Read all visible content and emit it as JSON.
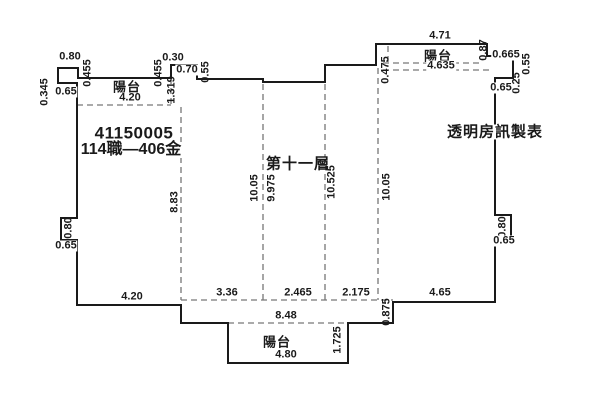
{
  "plan": {
    "serial": "41150005",
    "case_number": "114職—406金",
    "floor_label": "第十一層",
    "credit": "透明房訊製表"
  },
  "balconies": {
    "top_left": {
      "label": "陽台",
      "width": "4.20"
    },
    "top_right": {
      "label": "陽台",
      "outer_width": "4.71",
      "inner_width": "4.635"
    },
    "bottom": {
      "label": "陽台",
      "width": "4.80"
    }
  },
  "dims": {
    "top_left_tab_width": "0.80",
    "top_left_tab_left": "0.345",
    "top_left_tab_right": "0.455",
    "top_left_tab_below": "0.65",
    "top_step_offset": "0.455",
    "top_step_rise": "0.30",
    "top_step_width": "0.70",
    "top_step_drop": "0.55",
    "top_balcony_depth": "1.319",
    "right_balcony_step": "0.475",
    "right_balcony_end_height": "0.87",
    "right_balcony_end_width": "0.665",
    "right_edge_upper": "0.55",
    "right_edge_lower": "0.25",
    "right_edge_below": "0.65",
    "left_notch_height": "0.80",
    "left_notch_below": "0.65",
    "right_notch_height": "0.80",
    "right_notch_below": "0.65",
    "depth_left": "8.83",
    "depth_mid_left": "10.05",
    "depth_mid": "9.975",
    "depth_mid_right": "10.525",
    "depth_right": "10.05",
    "bottom_left": "4.20",
    "bottom_seg1": "3.36",
    "bottom_seg2": "2.465",
    "bottom_seg3": "2.175",
    "bottom_right": "4.65",
    "bottom_step": "0.875",
    "bottom_span": "8.48",
    "bottom_balcony_side": "1.725"
  },
  "colors": {
    "ink": "#1a1a1a",
    "dash_line": "#777777",
    "background": "#ffffff"
  }
}
